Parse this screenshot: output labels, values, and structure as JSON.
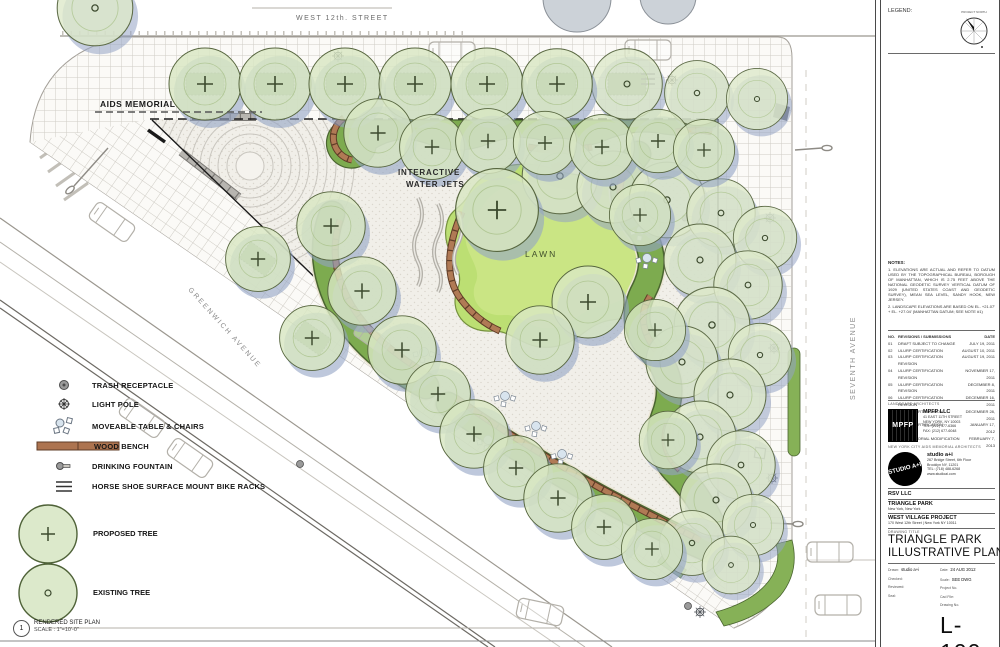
{
  "plan": {
    "street_top": "WEST 12th. STREET",
    "street_left": "GREENWICH AVENUE",
    "street_right": "SEVENTH AVENUE",
    "aids_memorial_label": "AIDS MEMORIAL",
    "water_jets_label_line1": "INTERACTIVE",
    "water_jets_label_line2": "WATER JETS",
    "lawn_label": "LAWN"
  },
  "legend": {
    "items": [
      "TRASH RECEPTACLE",
      "LIGHT POLE",
      "MOVEABLE TABLE & CHAIRS",
      "WOOD BENCH",
      "DRINKING FOUNTAIN",
      "HORSE SHOE SURFACE MOUNT BIKE RACKS",
      "PROPOSED TREE",
      "EXISTING TREE"
    ],
    "view_number": "1",
    "view_title": "RENDERED SITE PLAN",
    "view_scale": "SCALE : 1\"=10'-0\""
  },
  "titleblock": {
    "legend_label": "LEGEND:",
    "north_label": "PROJECT NORTH",
    "notes_title": "NOTES:",
    "note1": "1. ELEVATIONS ARE ACTUAL AND REFER TO DATUM USED BY THE TOPOGRAPHICAL BUREAU, BOROUGH OF MANHATTAN, WHICH IS 2.75 FEET ABOVE THE NATIONAL GEODETIC SURVEY VERTICAL DATUM OF 1929 (UNITED STATES COAST AND GEODETIC SURVEY), MEAN SEA LEVEL, SANDY HOOK, NEW JERSEY.",
    "note2": "2. LANDSCAPE ELEVATIONS ARE BASED ON EL. +21.07' + EL. +27.04' (MANHATTAN DATUM; SEE NOTE #1)",
    "rev_headers": [
      "NO.",
      "REVISIONS / SUBMISSIONS",
      "DATE"
    ],
    "revisions": [
      [
        "01",
        "DRAFT SUBJECT TO CHANGE",
        "JULY 19, 2011"
      ],
      [
        "02",
        "ULURP CERTIFICATION",
        "AUGUST 10, 2011"
      ],
      [
        "03",
        "ULURP CERTIFICATION REVISION",
        "AUGUST 19, 2011"
      ],
      [
        "04",
        "ULURP CERTIFICATION REVISION",
        "NOVEMBER 17, 2011"
      ],
      [
        "05",
        "ULURP CERTIFICATION REVISION",
        "DECEMBER 8, 2011"
      ],
      [
        "06",
        "ULURP CERTIFICATION REVISION",
        "DECEMBER 16, 2011"
      ],
      [
        "07",
        "ULURP CERTIFICATION REVISION",
        "DECEMBER 28, 2011"
      ],
      [
        "08",
        "ULURP CERTIFICATION REVISION",
        "JANUARY 17, 2012"
      ],
      [
        "09",
        "AIDS MEMORIAL MODIFICATION",
        "FEBRUARY 7, 2013"
      ]
    ],
    "landscape_architects_label": "LANDSCAPE ARCHITECTS",
    "mpfp_logo": "MPFP",
    "mpfp_name": "MPFP LLC",
    "mpfp_addr1": "41 EAST 11TH STREET",
    "mpfp_addr2": "NEW YORK, NY 10003",
    "mpfp_tel": "TEL: (212) 477-6366",
    "mpfp_fax": "FAX: (212) 677-6048",
    "memorial_architects_label": "NEW YORK CITY AIDS MEMORIAL ARCHITECTS",
    "studio_logo": "STUDIO A+I",
    "studio_name": "studio a+i",
    "studio_addr1": "267 Bridge Street, 6th Floor",
    "studio_addr2": "Brooklyn NY, 11201",
    "studio_tel": "TEL: (718) 488-6268",
    "studio_web": "www.studioai.com",
    "client": "RSV LLC",
    "project1_name": "TRIANGLE PARK",
    "project1_sub": "New York, New York",
    "project2_name": "WEST VILLAGE PROJECT",
    "project2_sub": "170 West 12th Street | New York NY 10011",
    "drawing_title_label": "DRAWING TITLE",
    "title_line1": "TRIANGLE PARK",
    "title_line2": "ILLUSTRATIVE PLAN",
    "drawn_label": "Drawn:",
    "drawn_value": "studio a+i",
    "checked_label": "Checked:",
    "reviewed_label": "Reviewed:",
    "seal_label": "Seal:",
    "date_label": "Date:",
    "date_value": "24 AUG 2012",
    "scale_label": "Scale:",
    "scale_value": "SEE DWG",
    "project_no_label": "Project No.",
    "cad_file_label": "Cad File:",
    "drawing_no_label": "Drawing No.",
    "sheet_number": "L-100"
  },
  "colors": {
    "tree_green": "#d8e7c2",
    "bed_green": "#7dab4f",
    "lawn_green": "#bcdf73",
    "bench_brown": "#ad7450",
    "shadow_blue": "#93a3c4"
  }
}
